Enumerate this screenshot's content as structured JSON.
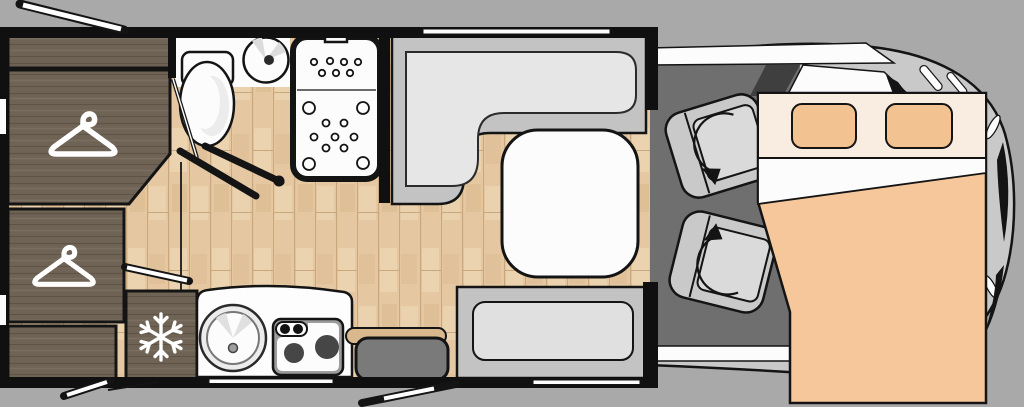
{
  "title": "motorhome-floor-plan",
  "colors": {
    "background": "#a9a9a9",
    "wall": "#101010",
    "white": "#fcfcfc",
    "wood_floor": "#e5c8a2",
    "wood_floor_seam": "#c9a87e",
    "wood_floor_light": "#f0dcbc",
    "wood_floor_dark": "#d9b98e",
    "dark_wood": "#6e6355",
    "dark_wood_grain": "#5d5346",
    "dark_wood_light": "#7d7264",
    "sofa_band": "#c3c3c3",
    "sofa_cushion": "#e6e6e6",
    "bench_outer": "#c3c3c3",
    "bench_inner": "#e0e0e0",
    "table_white": "#fcfcfc",
    "counter_white": "#fdfdfd",
    "stove_frame": "#9c9c9c",
    "burner": "#464646",
    "ottoman": "#7a7a7a",
    "tan_flap": "#d9b88e",
    "cab_floor": "#6f6f6f",
    "cab_body": "#c9c9c9",
    "cab_seat": "#c9c9c9",
    "cab_seat_cushion": "#dadada",
    "windscreen_dark": "#3f3f3f",
    "bed_pale": "#f9ede2",
    "bed_pillow": "#f3c291",
    "bed_mattress": "#f5c79b",
    "icon_white": "#ffffff"
  },
  "icons": {
    "hanger": "clothes-hanger-icon",
    "snowflake": "snowflake-icon",
    "swivel_arrow": "swivel-rotation-arrow-icon"
  },
  "furniture": [
    "overhead-locker",
    "wardrobe-upper",
    "wardrobe-lower",
    "cabinet",
    "refrigerator",
    "toilet",
    "washbasin",
    "shower-cubicle",
    "kitchen-counter",
    "kitchen-sink",
    "two-burner-stove",
    "dinette-l-sofa",
    "dinette-table",
    "bench-seat",
    "ottoman-seat",
    "swivel-cab-seat-front",
    "swivel-cab-seat-rear",
    "drop-down-double-bed"
  ]
}
